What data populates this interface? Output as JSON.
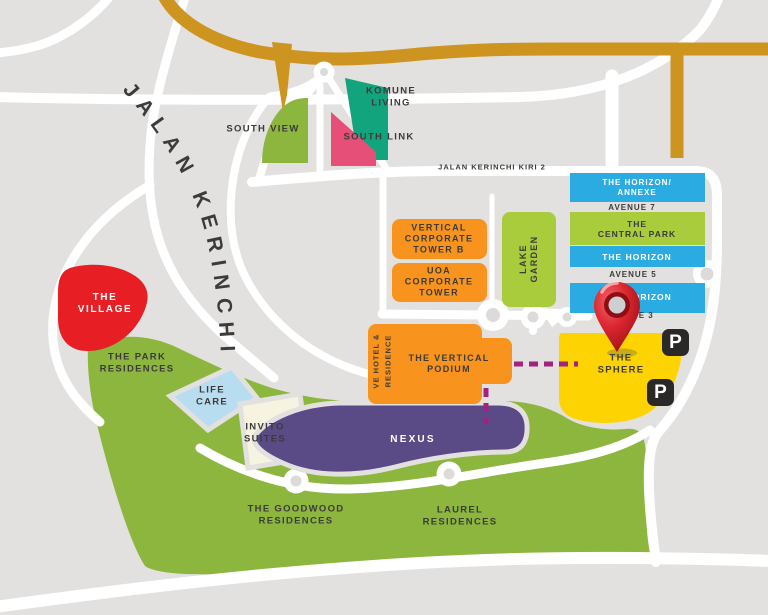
{
  "map": {
    "title": "Bangsar South / Kerinchi development map",
    "colors": {
      "background": "#e2e1e0",
      "road": "#ffffff",
      "highway_gold": "#cd9420",
      "teal": "#12a57d",
      "olive_green": "#8cb63d",
      "lime_green": "#a9cc3d",
      "pink": "#e64f78",
      "blue": "#2aabe2",
      "orange": "#f8941d",
      "red": "#e81e25",
      "light_blue": "#b9ddf0",
      "cream": "#f7f3e1",
      "purple": "#5a4a86",
      "yellow": "#fdd301",
      "dark_text": "#3c3b3a",
      "dashed_link": "#a1237f",
      "parking_bg": "#2a2928",
      "pin_red": "#d5232e"
    },
    "roads": {
      "jalan_kerinchi": "JALAN KERINCHI",
      "jalan_kerinchi_kiri_2": "JALAN KERINCHI KIRI 2",
      "avenue_7": "AVENUE 7",
      "avenue_5": "AVENUE 5",
      "avenue_3": "AVENUE 3"
    },
    "areas": {
      "komune_living": {
        "label": "KOMUNE\nLIVING"
      },
      "south_view": {
        "label": "SOUTH VIEW"
      },
      "south_link": {
        "label": "SOUTH LINK"
      },
      "the_horizon_annexe": {
        "label": "THE HORIZON/\nANNEXE"
      },
      "the_central_park": {
        "label": "THE\nCENTRAL PARK"
      },
      "the_horizon_upper": {
        "label": "THE HORIZON"
      },
      "the_horizon_lower": {
        "label": "THE HORIZON"
      },
      "vertical_corporate_tower_b": {
        "label": "VERTICAL\nCORPORATE\nTOWER B"
      },
      "uoa_corporate_tower": {
        "label": "UOA\nCORPORATE\nTOWER"
      },
      "lake_garden": {
        "label": "LAKE\nGARDEN"
      },
      "the_village": {
        "label": "THE\nVILLAGE"
      },
      "the_park_residences": {
        "label": "THE PARK\nRESIDENCES"
      },
      "life_care": {
        "label": "LIFE\nCARE"
      },
      "invito_suites": {
        "label": "INVITO\nSUITES"
      },
      "nexus": {
        "label": "NEXUS"
      },
      "ve_hotel_residence": {
        "label": "VE HOTEL &\nRESIDENCE"
      },
      "the_vertical_podium": {
        "label": "THE VERTICAL\nPODIUM"
      },
      "the_sphere": {
        "label": "THE\nSPHERE"
      },
      "the_goodwood_residences": {
        "label": "THE GOODWOOD\nRESIDENCES"
      },
      "laurel_residences": {
        "label": "LAUREL\nRESIDENCES"
      }
    },
    "markers": {
      "parking_label": "P"
    }
  }
}
